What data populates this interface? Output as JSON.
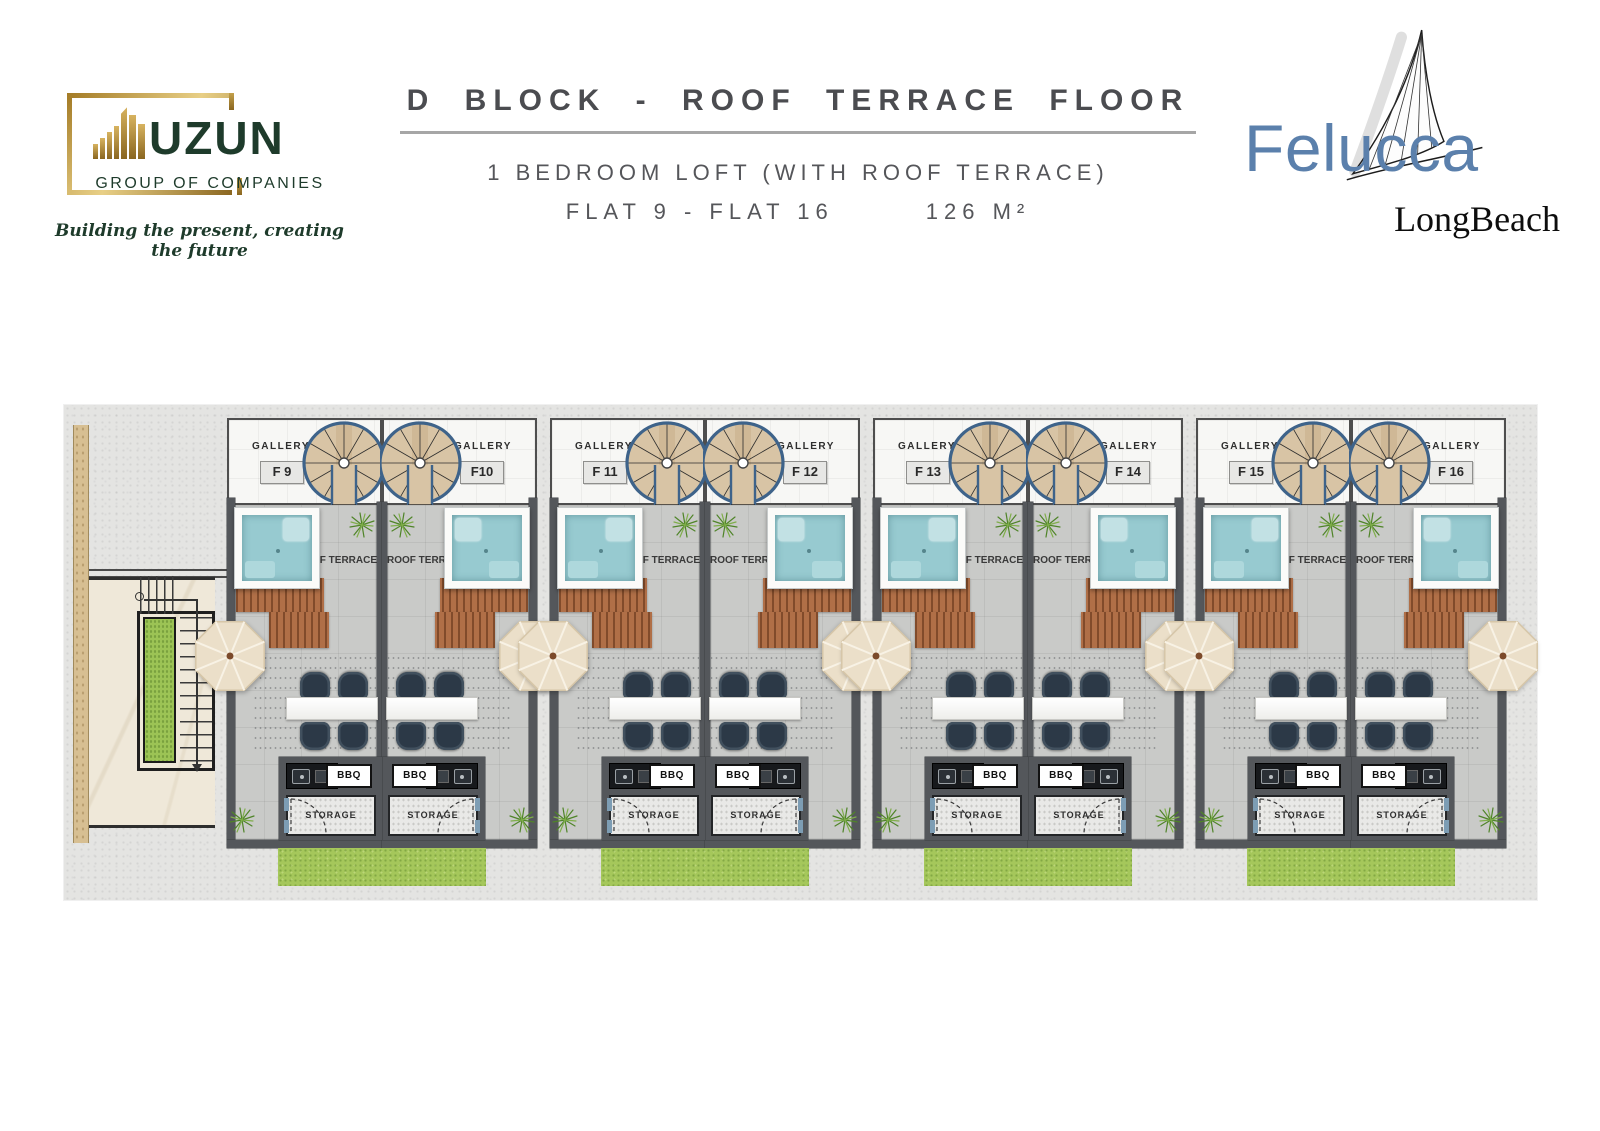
{
  "header": {
    "uzun_logo": {
      "name": "UZUN",
      "subtitle": "GROUP OF COMPANIES",
      "tagline": "Building the present, creating the future"
    },
    "title": "D BLOCK - ROOF TERRACE FLOOR",
    "subtitle": "1 BEDROOM LOFT (WITH ROOF TERRACE)",
    "flats_range": "FLAT 9 - FLAT 16",
    "area": "126 M²",
    "felucca_logo": {
      "name": "Felucca",
      "subtitle": "LongBeach"
    }
  },
  "plan": {
    "labels": {
      "gallery": "GALLERY",
      "roof_terrace": "ROOF TERRACE",
      "bbq": "BBQ",
      "storage": "STORAGE"
    },
    "units": [
      {
        "id": "F 9"
      },
      {
        "id": "F10"
      },
      {
        "id": "F 11"
      },
      {
        "id": "F 12"
      },
      {
        "id": "F 13"
      },
      {
        "id": "F 14"
      },
      {
        "id": "F 15"
      },
      {
        "id": "F 16"
      }
    ],
    "palette": {
      "wall_gray": "#54575b",
      "terrace_floor": "#c9cac8",
      "stair_blue": "#3e638a",
      "stair_wood": "#d8c4a5",
      "jacuzzi_teal": "#97cad0",
      "pergola_brown": "#b06f47",
      "umbrella_cream": "#ebdfc9",
      "grass_green": "#a5c75b",
      "door_jamb_blue": "#7d9db4",
      "uzun_green": "#1e3b2b",
      "gold": "#b08b33",
      "felucca_blue": "#5b80ac"
    }
  }
}
